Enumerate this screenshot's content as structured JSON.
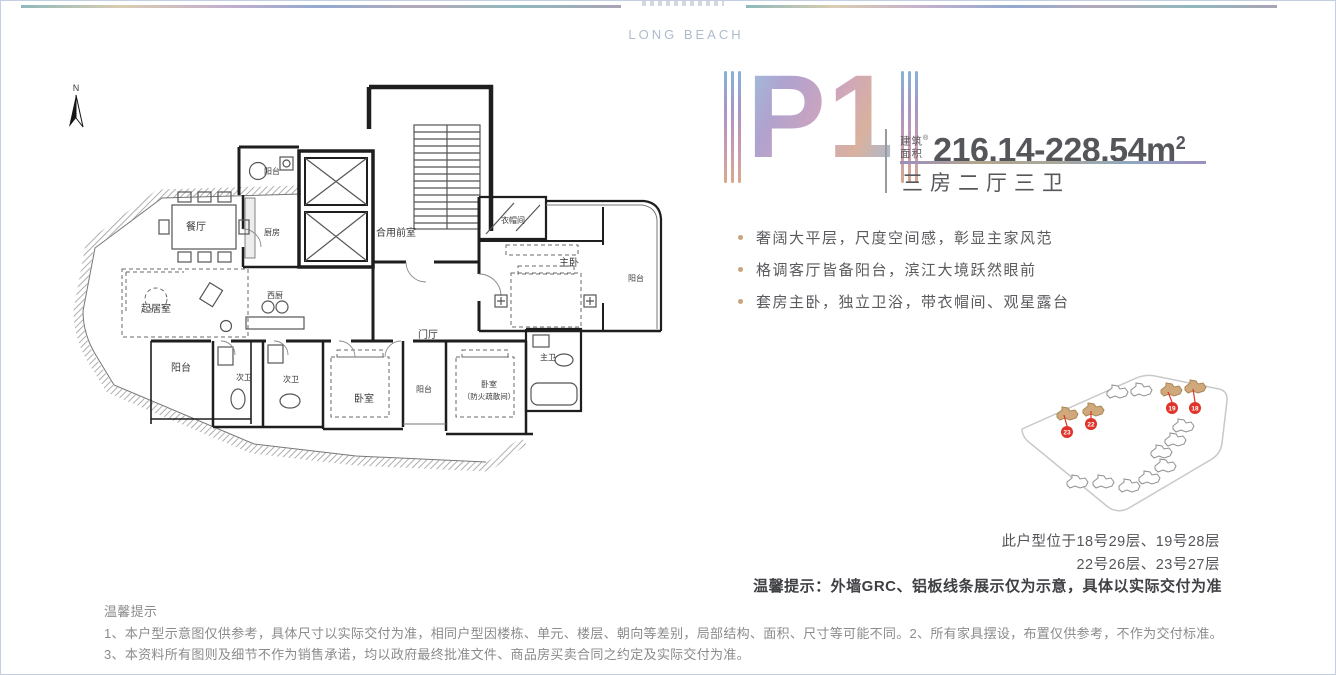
{
  "header": {
    "brand": "LONG BEACH"
  },
  "plan_code": "P1",
  "unit": {
    "area_label_line1": "建筑",
    "area_label_line2": "面积",
    "reg_mark": "®",
    "area_value": "216.14-228.54m",
    "area_sup": "2",
    "layout": "三房二厅三卫"
  },
  "features": [
    "奢阔大平层，尺度空间感，彰显主家风范",
    "格调客厅皆备阳台，滨江大境跃然眼前",
    "套房主卧，独立卫浴，带衣帽间、观星露台"
  ],
  "floorplan": {
    "north_label": "N",
    "rooms": [
      "阳台",
      "餐厅",
      "厨房",
      "起居室",
      "西厨",
      "合用前室",
      "门厅",
      "衣帽间",
      "主卧",
      "阳台",
      "阳台",
      "次卫",
      "次卫",
      "卧室",
      "阳台",
      "卧室",
      "（防火疏散间）",
      "主卫"
    ]
  },
  "site_plan": {
    "markers": [
      "23",
      "22",
      "19",
      "18"
    ]
  },
  "location_note": {
    "line1": "此户型位于18号29层、19号28层",
    "line2": "22号26层、23号27层"
  },
  "delivery_note": "温馨提示：外墙GRC、铝板线条展示仅为示意，具体以实际交付为准",
  "disclaimer": {
    "title": "温馨提示",
    "line1": "1、本户型示意图仅供参考，具体尺寸以实际交付为准，相同户型因楼栋、单元、楼层、朝向等差别，局部结构、面积、尺寸等可能不同。2、所有家具摆设，布置仅供参考，不作为交付标准。",
    "line2": "3、本资料所有图则及细节不作为销售承诺，均以政府最终批准文件、商品房买卖合同之约定及实际交付为准。"
  },
  "colors": {
    "accent_gradient_start": "#8db6d8",
    "accent_gradient_end": "#d3a48e",
    "bullet": "#c8a37e",
    "marker_red": "#e03228",
    "highlight_building": "#cfa97b",
    "page_border": "#c3cfe0"
  }
}
